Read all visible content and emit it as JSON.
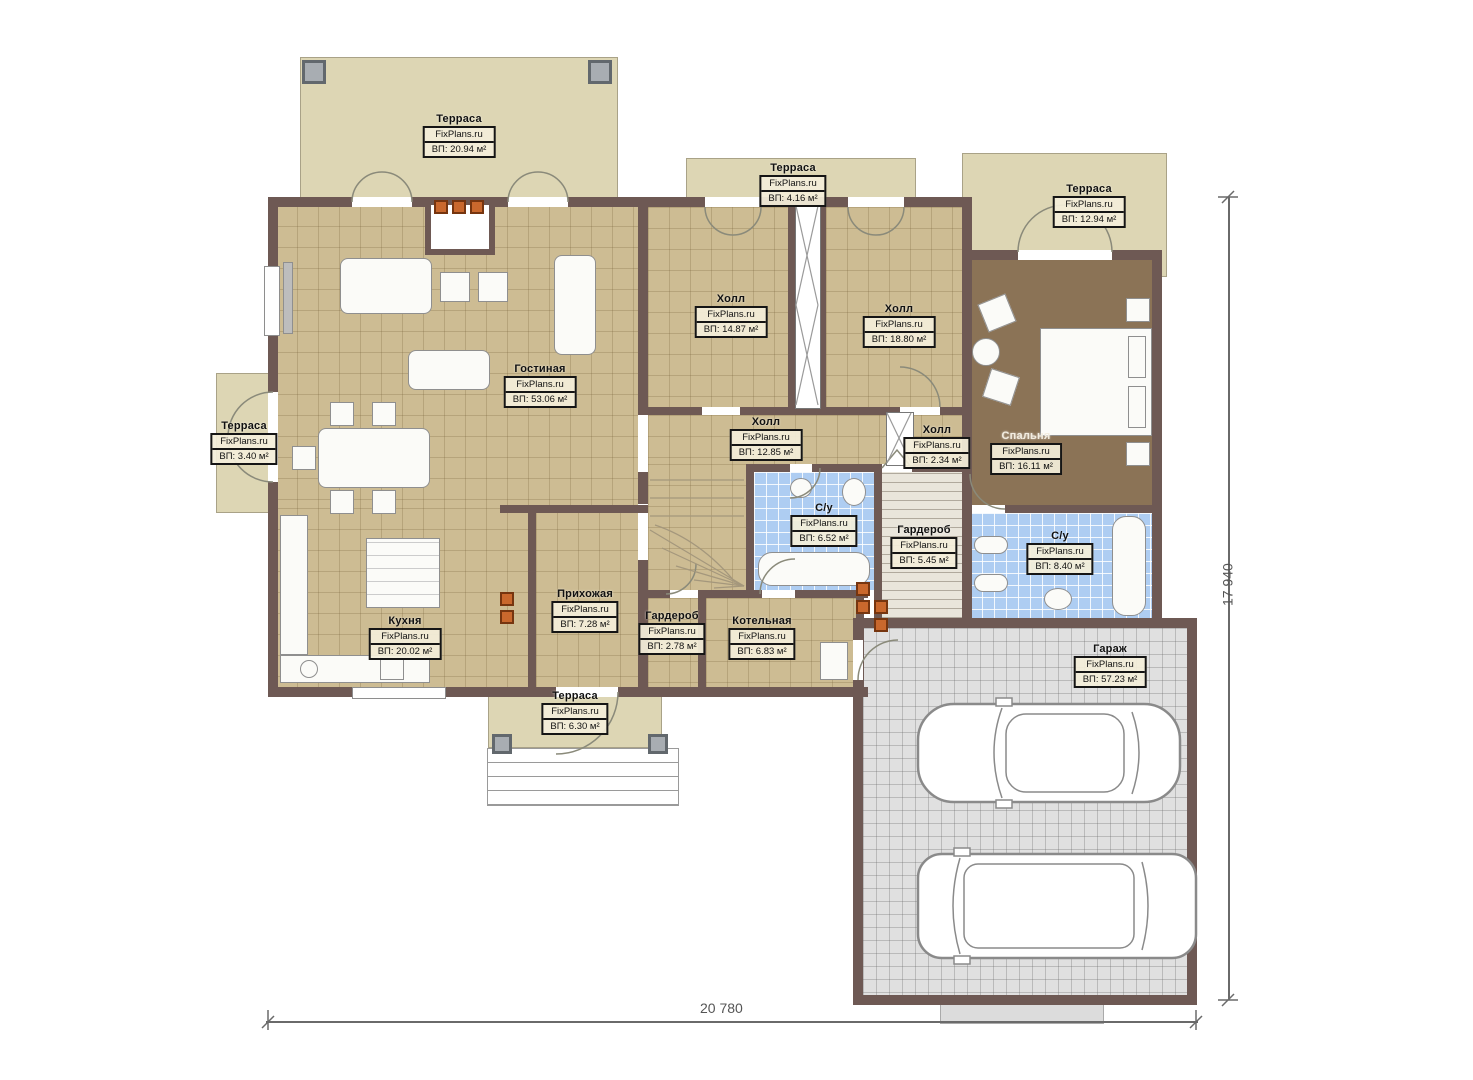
{
  "watermark": "FixPlans.ru",
  "dimensions": {
    "width_label": "20 780",
    "height_label": "17 940"
  },
  "colors": {
    "wall": "#6e5954",
    "terrace_floor": "#ddd6b4",
    "tile_floor": "#cdbc93",
    "bathroom_floor": "#aecdf2",
    "garage_floor": "#e0e0e0",
    "bedroom_floor": "#8b7356",
    "vent": "#c9682d"
  },
  "rooms": {
    "terrace_top_left": {
      "name": "Терраса",
      "area": "ВП: 20.94 м²"
    },
    "terrace_top_mid": {
      "name": "Терраса",
      "area": "ВП: 4.16 м²"
    },
    "terrace_top_right": {
      "name": "Терраса",
      "area": "ВП: 12.94 м²"
    },
    "terrace_left": {
      "name": "Терраса",
      "area": "ВП: 3.40 м²"
    },
    "terrace_bottom": {
      "name": "Терраса",
      "area": "ВП: 6.30 м²"
    },
    "living": {
      "name": "Гостиная",
      "area": "ВП: 53.06 м²"
    },
    "kitchen": {
      "name": "Кухня",
      "area": "ВП: 20.02 м²"
    },
    "entry": {
      "name": "Прихожая",
      "area": "ВП: 7.28 м²"
    },
    "hall1": {
      "name": "Холл",
      "area": "ВП: 14.87 м²"
    },
    "hall2": {
      "name": "Холл",
      "area": "ВП: 18.80 м²"
    },
    "hall3": {
      "name": "Холл",
      "area": "ВП: 12.85 м²"
    },
    "hall4": {
      "name": "Холл",
      "area": "ВП: 2.34 м²"
    },
    "bedroom": {
      "name": "Спальня",
      "area": "ВП: 16.11 м²"
    },
    "bath1": {
      "name": "С/у",
      "area": "ВП: 6.52 м²"
    },
    "wardrobe1": {
      "name": "Гардероб",
      "area": "ВП: 5.45 м²"
    },
    "bath2": {
      "name": "С/у",
      "area": "ВП: 8.40 м²"
    },
    "wardrobe2": {
      "name": "Гардероб",
      "area": "ВП: 2.78 м²"
    },
    "boiler": {
      "name": "Котельная",
      "area": "ВП: 6.83 м²"
    },
    "garage": {
      "name": "Гараж",
      "area": "ВП: 57.23 м²"
    }
  }
}
